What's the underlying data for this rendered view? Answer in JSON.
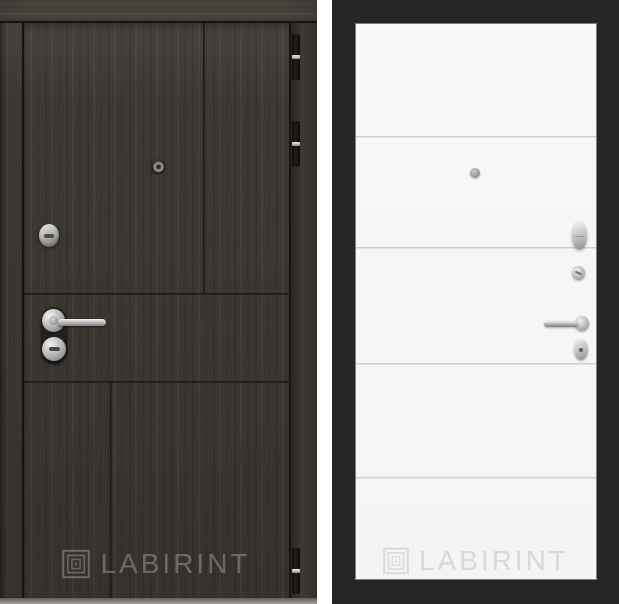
{
  "brand": {
    "name": "LABIRINT"
  },
  "left_door": {
    "label": "Dark wenge oak entry door, exterior side",
    "watermark_text": "LABIRINT",
    "hinge_count": 3,
    "hardware": [
      "peephole",
      "key-cylinder",
      "lever-handle",
      "key-cylinder-with-backplate"
    ],
    "colors": {
      "wood": "#3f3934",
      "wood_frame": "#49423c",
      "groove": "#1b1713",
      "hinge": "#15110e",
      "hardware_silver": "#c7c7c7",
      "watermark": "#948e84"
    }
  },
  "right_door": {
    "label": "White door panel, interior side, black frame",
    "watermark_text": "LABIRINT",
    "groove_line_count": 4,
    "hardware": [
      "peephole",
      "cylinder-knob",
      "thumbturn-knob",
      "lever-handle",
      "keyhole-escutcheon"
    ],
    "colors": {
      "frame": "#262626",
      "leaf": "#f6f6f6",
      "groove": "#c4c4c4",
      "hardware_silver": "#b5b5b5",
      "watermark": "#d8d8d8"
    }
  }
}
